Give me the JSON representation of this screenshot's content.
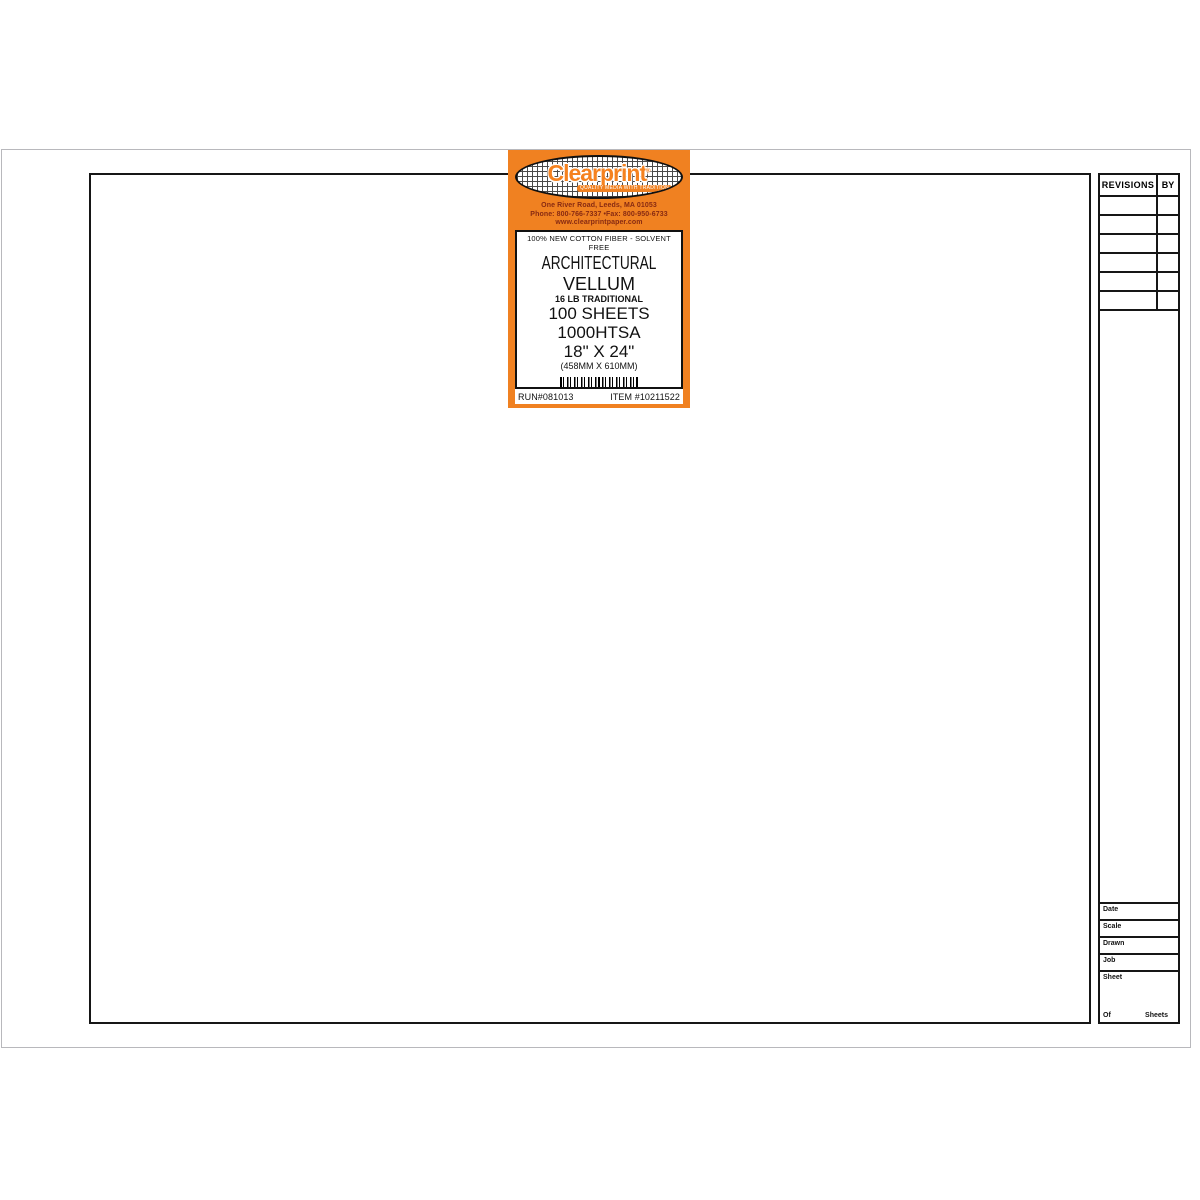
{
  "colors": {
    "label_orange": "#f08121",
    "logo_orange": "#f5821f",
    "address_red": "#872a12",
    "line_black": "#161616",
    "sheet_edge_gray": "#b8b8bc"
  },
  "label": {
    "brand": "Clearprint",
    "registered": "®",
    "tagline": "QUALITY MEDIA WITH TRADITION",
    "address_line1": "One River Road, Leeds, MA 01053",
    "address_line2": "Phone: 800-766-7337 •Fax: 800-950-6733",
    "address_line3": "www.clearprintpaper.com",
    "fiber_line": "100% NEW COTTON FIBER - SOLVENT FREE",
    "product_line1": "ARCHITECTURAL",
    "product_line2": "VELLUM",
    "weight_line": "16 LB TRADITIONAL",
    "sheets_line": "100 SHEETS",
    "sku_line": "1000HTSA",
    "size_line": "18\" X 24\"",
    "size_metric": "(458MM X 610MM)",
    "barcode": {
      "left_digit": "0",
      "group1": "00000",
      "group2": "00000",
      "right_digit": "6"
    },
    "run_number": "RUN#081013",
    "item_number": "ITEM #10211522"
  },
  "title_block": {
    "revisions_header": "REVISIONS",
    "by_header": "BY",
    "revision_rows": 6,
    "fields": [
      {
        "label": "Date"
      },
      {
        "label": "Scale"
      },
      {
        "label": "Drawn"
      },
      {
        "label": "Job"
      }
    ],
    "sheet_label": "Sheet",
    "of_label": "Of",
    "sheets_label": "Sheets"
  }
}
